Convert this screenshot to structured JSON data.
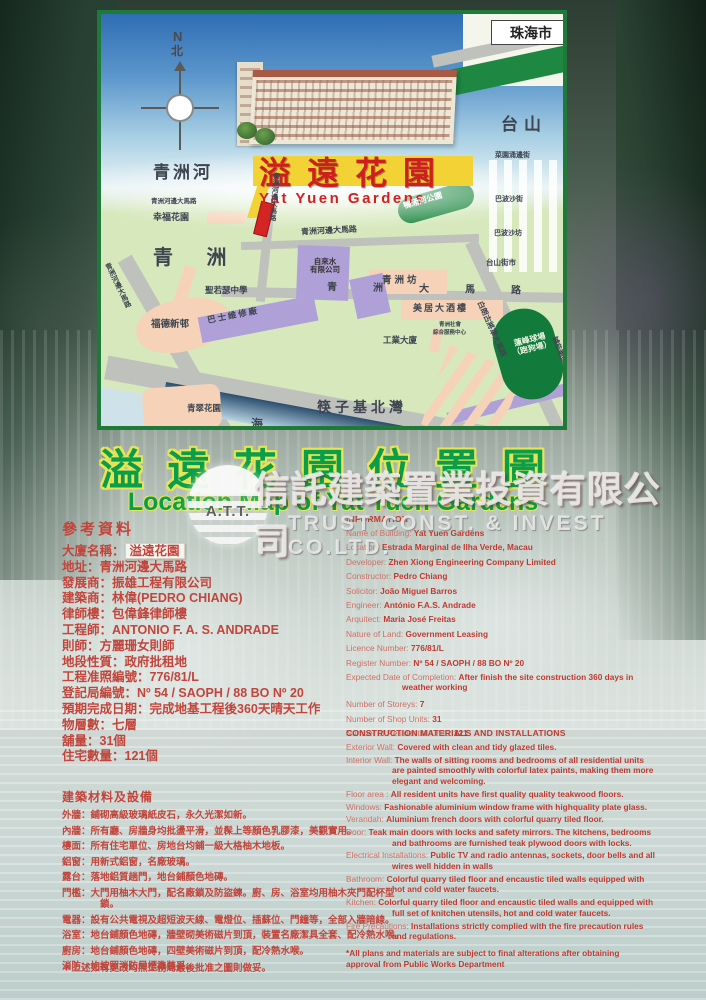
{
  "title": {
    "zh": "溢遠花園位置圖",
    "en": "Location Map of Yat Yuen Gardens"
  },
  "watermark": {
    "abbr": "A.T.T.",
    "zh": "信託建築置業投資有限公司",
    "en": "TRUST CONST. & INVEST CO.LTD."
  },
  "map": {
    "labels": {
      "zhuhai": "珠海市",
      "compass_n": "N",
      "compass_bei": "北",
      "river": "青洲河",
      "banner_zh": "溢遠花園",
      "banner_en": "Yat Yuen Gardens",
      "park": "鴨涌河公園",
      "taishan": "台山",
      "st_garden_edge": "菜園涌邊街",
      "st_bobosha": "巴波沙街",
      "st_bobosha_fong": "巴波沙坊",
      "taishan_market": "台山街市",
      "marginal_top": "青洲河邊大馬路",
      "marginal_small": "青洲河邊大馬路",
      "marginal_vert": "青洲河邊大馬路",
      "marginal_left": "青洲河邊大馬路",
      "happiness": "幸福花園",
      "qingzhou": "青 洲",
      "school": "聖若瑟中學",
      "water_co1": "自來水",
      "water_co2": "有限公司",
      "bus_depot": "巴士維修廠",
      "qz_fong": "青洲坊",
      "qz_road": "青洲大馬路",
      "hotel": "美居大酒樓",
      "svc1": "青洲社會",
      "svc2": "綜合服務中心",
      "industrial": "工業大廈",
      "fortune": "福德新邨",
      "canidrome1": "蓮峰球場",
      "canidrome2": "（跑狗場）",
      "castelo": "白朗古將軍大馬路",
      "lacerda": "罅些喇提督大馬路",
      "green_garden": "青翠花園",
      "bay": "筷子基北灣",
      "sea": "海"
    }
  },
  "reference": {
    "header": "參考資料",
    "items": [
      {
        "label": "大廈名稱：",
        "value": "溢遠花園"
      },
      {
        "label": "地址：",
        "value": "青洲河邊大馬路"
      },
      {
        "label": "發展商：",
        "value": "振雄工程有限公司"
      },
      {
        "label": "建築商：",
        "value": "林偉(PEDRO CHIANG)"
      },
      {
        "label": "律師樓：",
        "value": "包偉鋒律師樓"
      },
      {
        "label": "工程師：",
        "value": "ANTONIO F. A. S. ANDRADE"
      },
      {
        "label": "則師：",
        "value": "方麗珊女則師"
      },
      {
        "label": "地段性質：",
        "value": "政府批租地"
      },
      {
        "label": "工程准照編號：",
        "value": "776/81/L"
      },
      {
        "label": "登記局編號：",
        "value": "Nº 54 / SAOPH / 88 BO Nº 20"
      },
      {
        "label": "預期完成日期：",
        "value": "完成地基工程後360天晴天工作"
      },
      {
        "label": "物層數：",
        "value": "七層"
      },
      {
        "label": "舖量：",
        "value": "31個"
      },
      {
        "label": "住宅數量：",
        "value": "121個"
      }
    ]
  },
  "materials_zh": {
    "header": "建築材料及設備",
    "items": [
      "外牆：鋪砌高級玻璃紙皮石，永久光潔如新。",
      "內牆：所有廳、房牆身均批盪平滑，並髹上等顏色乳膠漆，美觀實用。",
      "樓面：所有住宅單位、房地台均鋪一級大格柚木地板。",
      "鋁窗：用新式鋁窗，名廠玻璃。",
      "露台：落地鋁質趟門，地台鋪顏色地磚。",
      "門檻：大門用柚木大門，配名廠鎖及防盜鍊。廚、房、浴室均用柚木夾門配杯型鎖。",
      "電器：設有公共電視及超短波天線、電燈位、插蘇位、門鐘等，全部入牆暗線。",
      "浴室：地台鋪顏色地磚，牆壁砌美術磁片到頂，裝置名廠潔具全套、配冷熱水喉。",
      "廚房：地台鋪顏色地磚，四壁美術磁片到頂，配冷熱水喉。",
      "消防：均按照消防局標準裝妥。"
    ],
    "footnote": "＊上述如有更改均照工務局最後批准之圖則做妥。"
  },
  "information": {
    "header": "INFORMATION",
    "items": [
      {
        "label": "Name of Building: ",
        "value": "Yat Yuen Gardens"
      },
      {
        "label": "Location: ",
        "value": "Estrada Marginal de Ilha Verde, Macau"
      },
      {
        "label": "Developer: ",
        "value": "Zhen Xiong Engineering Company Limited"
      },
      {
        "label": "Constructor: ",
        "value": "Pedro Chiang"
      },
      {
        "label": "Solicitor: ",
        "value": "João Miguel Barros"
      },
      {
        "label": "Engineer: ",
        "value": "António F.A.S. Andrade"
      },
      {
        "label": "Arquitect: ",
        "value": "Maria José Freitas"
      },
      {
        "label": "Nature of Land: ",
        "value": "Government Leasing"
      },
      {
        "label": "Licence Number: ",
        "value": "776/81/L"
      },
      {
        "label": "Register Number: ",
        "value": "Nº 54 / SAOPH / 88 BO Nº 20"
      },
      {
        "label": "Expected Date of Completion: ",
        "value": "After finish the site construction 360 days in weather working"
      },
      {
        "label": "Number of Storeys: ",
        "value": "7"
      },
      {
        "label": "Number of Shop Units: ",
        "value": "31"
      },
      {
        "label": "Number of Residential Units: ",
        "value": "121"
      }
    ]
  },
  "construction_en": {
    "header": "CONSTRUCTION MATERIALS AND INSTALLATIONS",
    "items": [
      {
        "label": "Exterior Wall: ",
        "value": "Covered with clean and tidy glazed tiles."
      },
      {
        "label": "Interior Wall: ",
        "value": "The walls of sitting rooms and bedrooms of all residential units are painted smoothly with colorful latex paints, making them more elegant and welcoming."
      },
      {
        "label": "Floor area : ",
        "value": "All resident units have first quality quality teakwood floors."
      },
      {
        "label": "Windows: ",
        "value": "Fashionable aluminium window frame with highquality plate glass."
      },
      {
        "label": "Verandah: ",
        "value": "Aluminium french doors with colorful quarry tiled floor."
      },
      {
        "label": "Door: ",
        "value": "Teak main doors with locks and safety mirrors. The kitchens, bedrooms and bathrooms are furnished teak plywood doors with locks."
      },
      {
        "label": "Electrical Installations: ",
        "value": "Public TV and radio antennas, sockets, door bells and all wires well hidden in walls"
      },
      {
        "label": "Bathroom: ",
        "value": "Colorful quarry tiled floor and encaustic tiled walls equipped with hot and cold water faucets."
      },
      {
        "label": "Kitchen: ",
        "value": "Colorful quarry tiled floor and encaustic tiled walls and equipped with full set of knitchen utensils, hot and cold water faucets."
      },
      {
        "label": "Fire Precautions: ",
        "value": "Installations strictly complied with the fire precaution rules and regulations."
      }
    ],
    "footnote": "*All plans and materials are subject to final alterations after obtaining approval from Public Works Department"
  }
}
